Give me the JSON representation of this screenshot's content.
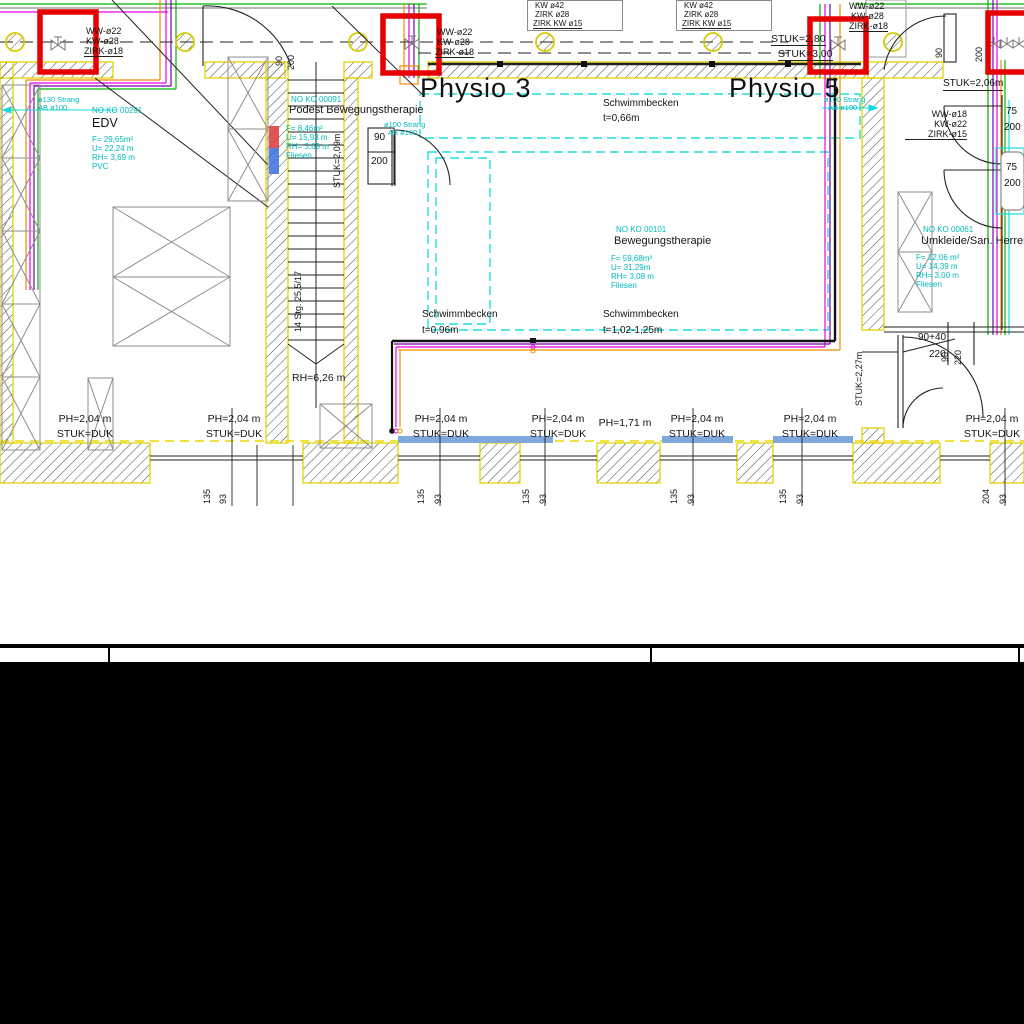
{
  "titles": {
    "physio3": "Physio 3",
    "physio5": "Physio 5"
  },
  "rooms": {
    "edv": {
      "no": "NO KO 00291",
      "name": "EDV",
      "area": "F=  29,65m²",
      "perimeter": "U=  22,24 m",
      "height": "RH=  3,69 m",
      "floor": "PVC"
    },
    "podest": {
      "no": "NO KO 00091",
      "name": "Podest Bewegungstherapie",
      "area": "F=  8,46m²",
      "perimeter": "U=  15,93 m",
      "height": "RH=  3,69 m",
      "floor": "Fliesen"
    },
    "beweg": {
      "no": "NO KO 00101",
      "name": "Bewegungstherapie",
      "area": "F=  59,68m²",
      "perimeter": "U=  31,29m",
      "height": "RH=  3,08 m",
      "floor": "Fliesen"
    },
    "umkleide": {
      "no": "NO KO 00061",
      "name": "Umkleide/San. Herren",
      "area": "F=  12,06 m²",
      "perimeter": "U=  14,39 m",
      "height": "RH=  3,00 m",
      "floor": "Fliesen"
    }
  },
  "pools": {
    "top": {
      "name": "Schwimmbecken",
      "depth": "t=0,66m"
    },
    "left": {
      "name": "Schwimmbecken",
      "depth": "t=0,96m"
    },
    "main": {
      "name": "Schwimmbecken",
      "depth": "t=1,02-1,25m"
    }
  },
  "pipes": {
    "riser_left": [
      "WW-ø22",
      "KW-ø28",
      "ZIRK-ø18"
    ],
    "riser_mid": [
      "WW-ø22",
      "KW-ø28",
      "ZIRK-ø18"
    ],
    "riser_right": [
      "WW-ø22",
      "KW-ø28",
      "ZIRK-ø18"
    ],
    "riser_far_right": [
      "WW-ø18",
      "KW-ø22",
      "ZIRK-ø15"
    ],
    "box1": [
      "KW ø42",
      "ZIRK ø28",
      "ZIRK KW ø15"
    ],
    "box2": [
      "KW ø42",
      "ZIRK ø28",
      "ZIRK KW ø15"
    ],
    "strang_left": [
      "ø130 Strang",
      "AB ø100"
    ],
    "strang_mid": [
      "ø100 Strang",
      "AB ø100"
    ],
    "strang_right": [
      "ø100 Strang",
      "AB ø100"
    ]
  },
  "stuk": {
    "s280": "STUK=2,80",
    "s300": "STUK=3,00",
    "s206": "STUK=2,06m",
    "s209": "STUK=2,09m",
    "s227": "STUK=2,27m",
    "duk": "STUK=DUK"
  },
  "heights": {
    "ph204": "PH=2,04 m",
    "ph171": "PH=1,71 m"
  },
  "stairs": {
    "steps": "14 Stg. 25,5/17",
    "headroom": "RH=6,26 m"
  },
  "doors": {
    "w90": "90",
    "h200": "200",
    "w75": "75",
    "w9040": "90+40",
    "h220": "220"
  },
  "dims": {
    "w135": "135",
    "w93": "93",
    "w204": "204",
    "d90": "90",
    "d220": "220"
  },
  "colors": {
    "markup_red": "#e60000",
    "cad_cyan": "#00c6c6",
    "wall_yellow": "#e8d900",
    "window_blue": "#7fa8dc"
  }
}
